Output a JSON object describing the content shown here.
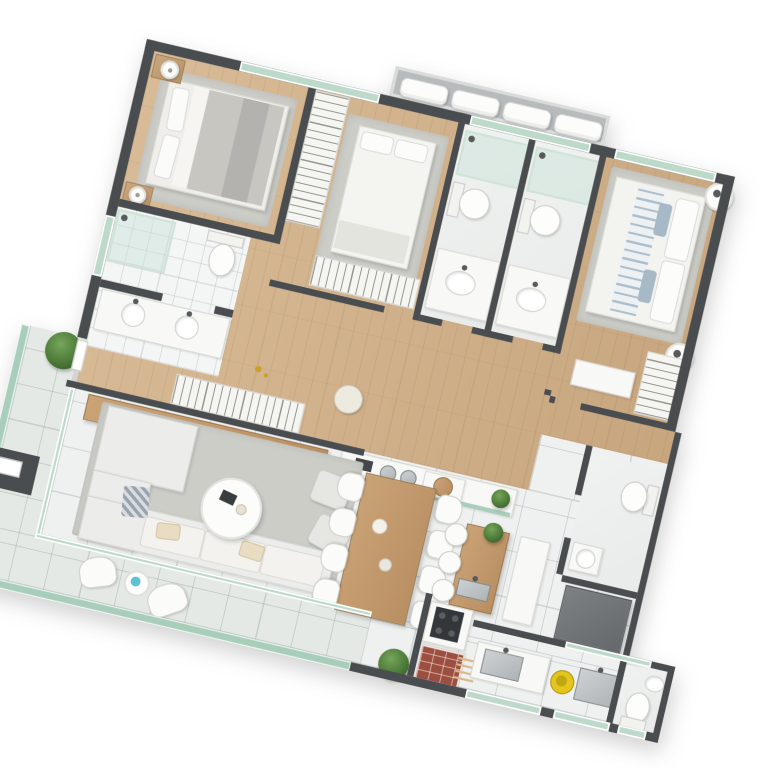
{
  "scene": {
    "type": "apartment-floorplan-3d-render",
    "view": "top-down",
    "rotation_deg": 13.2,
    "background": "#ffffff"
  },
  "palette": {
    "wall": "#4a4d4f",
    "wood": "#d8bb97",
    "wood2": "#c7a67e",
    "tile": "#eff1f1",
    "balcony": "#e4e9e6",
    "rug": "#cdcdc8",
    "glass": "#bcd9c9",
    "glassrail": "#a9cdbb",
    "brick": "#9c4f3e",
    "appliance": "#73777a",
    "cream": "#e8dcc2",
    "yellow": "#e3c51d",
    "blue": "#5fc0d6",
    "plant_green": "#4c7a38"
  },
  "rooms": [
    {
      "name": "bedroom-1",
      "floor": "wood",
      "furniture": [
        "double-bed",
        "rug",
        "nightstand-2x",
        "lamp-2x"
      ]
    },
    {
      "name": "bedroom-2",
      "floor": "wood",
      "furniture": [
        "double-bed",
        "rug",
        "wardrobe-L",
        "wardrobe-bottom"
      ]
    },
    {
      "name": "master-bedroom",
      "floor": "wood",
      "furniture": [
        "double-bed-striped",
        "rug",
        "round-nightstand-2x",
        "wardrobe",
        "bench"
      ]
    },
    {
      "name": "bathroom-1",
      "floor": "white-tile",
      "fixtures": [
        "shower",
        "toilet",
        "double-vanity"
      ]
    },
    {
      "name": "bathroom-2",
      "floor": "marble",
      "fixtures": [
        "shower",
        "toilet",
        "vanity"
      ]
    },
    {
      "name": "bathroom-3",
      "floor": "marble",
      "fixtures": [
        "shower",
        "toilet",
        "vanity"
      ]
    },
    {
      "name": "lavabo",
      "floor": "white",
      "fixtures": [
        "toilet",
        "small-basin"
      ]
    },
    {
      "name": "service-bathroom",
      "floor": "white",
      "fixtures": [
        "toilet",
        "corner-sink"
      ]
    },
    {
      "name": "corridor",
      "floor": "wood",
      "furniture": [
        "hanger-rack",
        "pouf",
        "sideboard"
      ]
    },
    {
      "name": "living-room",
      "floor": "tile",
      "furniture": [
        "l-shaped-sofa",
        "coffee-table",
        "armchair-2x",
        "rug",
        "sideboard",
        "kitchen-counter"
      ]
    },
    {
      "name": "dining-area",
      "floor": "tile",
      "furniture": [
        "wood-table",
        "chairs-8x"
      ]
    },
    {
      "name": "kitchen",
      "floor": "tile",
      "furniture": [
        "island",
        "bar-stools-3x",
        "cooktop",
        "brick-grill",
        "counter",
        "fridge"
      ]
    },
    {
      "name": "service-area",
      "floor": "tile",
      "fixtures": [
        "kitchen-sink",
        "laundry-tank",
        "yellow-basin"
      ]
    },
    {
      "name": "balcony",
      "floor": "green-tile",
      "furniture": [
        "lounge-chair-2x",
        "side-table",
        "plants"
      ],
      "edge": "glass-railing"
    },
    {
      "name": "ac-ledge",
      "floor": "concrete",
      "equipment": [
        "ac-condenser-4x"
      ]
    }
  ],
  "counts": {
    "ac_units": 4,
    "dining_chairs_per_side": 4,
    "bar_stools": 3,
    "lounge_chairs": 2,
    "grill_skewers": 4,
    "vanity_basins": 2
  }
}
